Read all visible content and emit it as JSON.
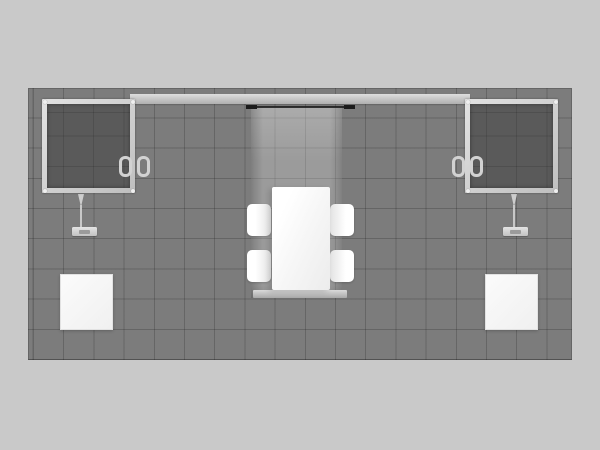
{
  "scene": {
    "name": "exhibit-booth-overhead-render",
    "description": "Overhead 3D rendering of an inline trade show exhibit booth: gray tiled carpet floor, header beam, two wall-mounted flat screens with clamp brackets and floor stands, central translucent fabric tower with a white conference table and four chairs, tower base bar, and two white pedestal cubes.",
    "colors": {
      "background": "#c9c9c9",
      "floor": "#7c7c7c",
      "grid_line": "rgba(20,20,20,0.22)",
      "screen_fill": "#5a5a5a",
      "frame_mid": "#bfbfbf",
      "header_bar_top": "#dedede",
      "header_bar_bottom": "#b0b0b0",
      "rail_black": "#1b1b1b",
      "furniture_white": "#f6f6f6",
      "pedestal_white": "#f0f0f0",
      "stand_metal": "#d2d2d2"
    },
    "floor_grid": {
      "columns": 18,
      "rows": 9,
      "tile_px": 30
    },
    "inventory": {
      "flat_screens": 2,
      "chairs": 4,
      "tables": 1,
      "pedestal_cubes": 2,
      "monitor_stands": 2
    }
  }
}
